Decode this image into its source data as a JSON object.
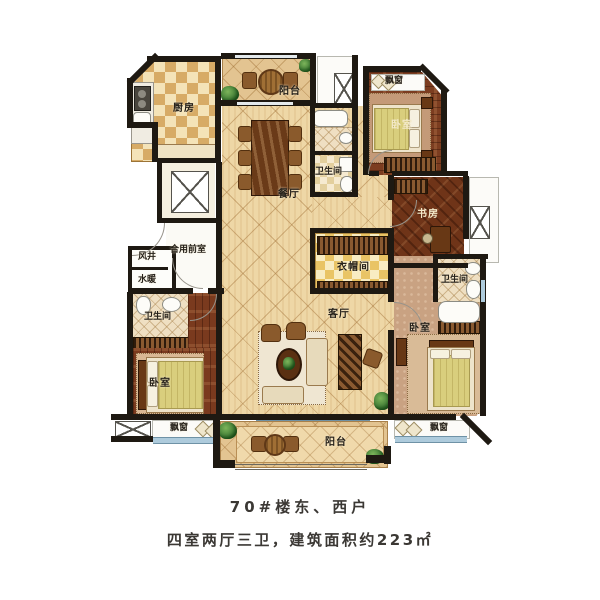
{
  "labels": {
    "kitchen": "厨房",
    "balcony_top": "阳台",
    "dining": "餐厅",
    "bath_center": "卫生间",
    "bay_top_right": "飘窗",
    "bedroom_top_right": "卧室",
    "study": "书房",
    "closet": "衣帽间",
    "vestibule": "合用前室",
    "wind_shaft": "风井",
    "plumbing": "水暖",
    "bath_left": "卫生间",
    "bedroom_left": "卧室",
    "bay_bottom_left": "飘窗",
    "living": "客厅",
    "bath_right": "卫生间",
    "bedroom_right": "卧室",
    "bay_bottom_right": "飘窗",
    "balcony_bottom": "阳台"
  },
  "caption": {
    "line1": "70#楼东、西户",
    "line2": "四室两厅三卫，建筑面积约223㎡"
  },
  "colors": {
    "wall": "#1e1912",
    "floor_tile": "#eed7a6",
    "wood": "#7c3d20",
    "glass": "#aecbdc",
    "blanket": "#d9ce7d",
    "caption_text": "#3b3834"
  }
}
